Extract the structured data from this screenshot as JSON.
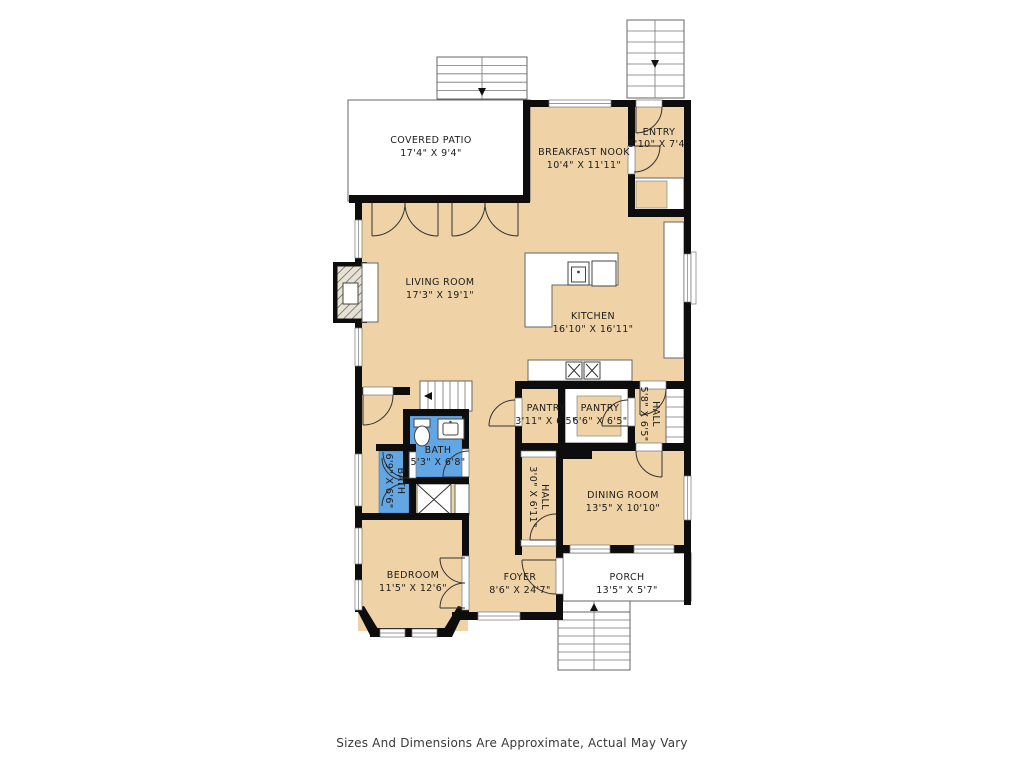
{
  "caption": "Sizes And Dimensions Are Approximate, Actual May Vary",
  "colors": {
    "floor": "#efd3a6",
    "bath": "#63a6e4",
    "wall": "#0d0d0d"
  },
  "rooms": {
    "covered_patio": {
      "name": "COVERED PATIO",
      "dims": "17'4\" X 9'4\""
    },
    "breakfast_nook": {
      "name": "BREAKFAST NOOK",
      "dims": "10'4\" X 11'11\""
    },
    "entry": {
      "name": "ENTRY",
      "dims": "5'10\" X 7'4\""
    },
    "living_room": {
      "name": "LIVING ROOM",
      "dims": "17'3\" X 19'1\""
    },
    "kitchen": {
      "name": "KITCHEN",
      "dims": "16'10\" X 16'11\""
    },
    "pantry_left": {
      "name": "PANTRY",
      "dims": "3'11\" X 6'5\""
    },
    "pantry_right": {
      "name": "PANTRY",
      "dims": "6'6\" X 6'5\""
    },
    "hall_upper": {
      "name": "HALL",
      "dims": "5'8\" X 6'5\""
    },
    "dining_room": {
      "name": "DINING ROOM",
      "dims": "13'5\" X 10'10\""
    },
    "hall_lower": {
      "name": "HALL",
      "dims": "3'0\" X 6'11\""
    },
    "bath_main": {
      "name": "BATH",
      "dims": "5'3\" X 6'8\""
    },
    "bath_second": {
      "name": "BATH",
      "dims": "6'9\" X 6'6\""
    },
    "bedroom": {
      "name": "BEDROOM",
      "dims": "11'5\" X 12'6\""
    },
    "foyer": {
      "name": "FOYER",
      "dims": "8'6\" X 24'7\""
    },
    "porch": {
      "name": "PORCH",
      "dims": "13'5\" X 5'7\""
    }
  }
}
